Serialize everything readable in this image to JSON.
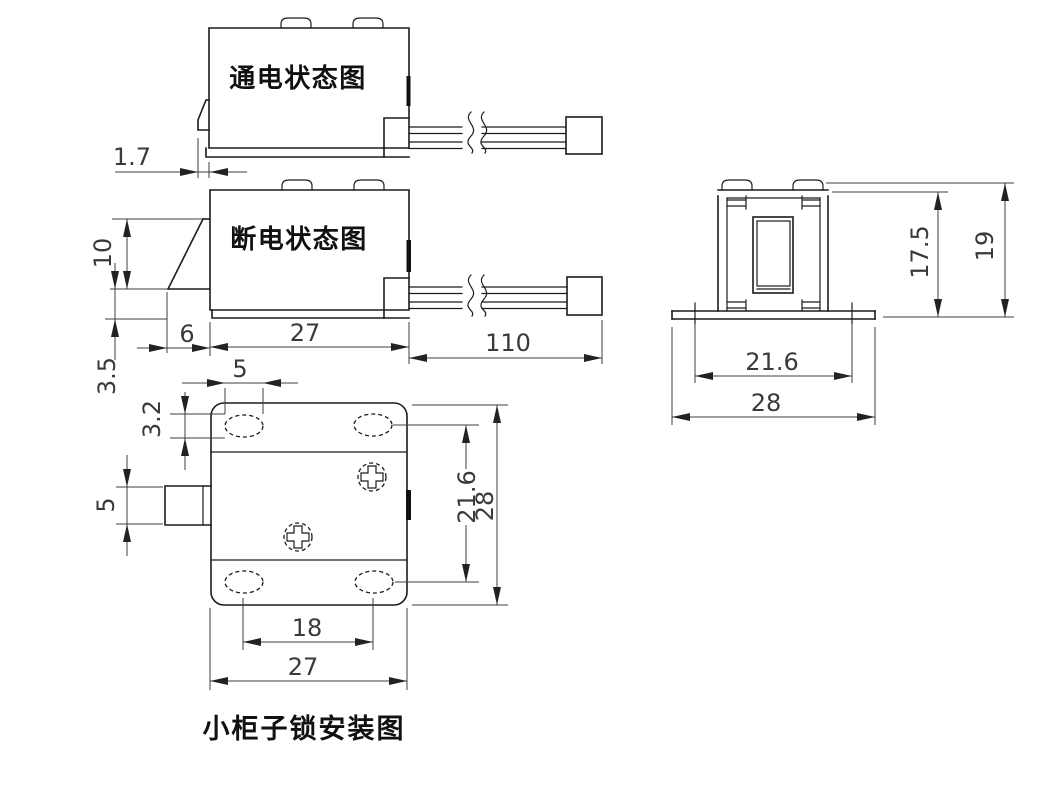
{
  "page": {
    "background": "#ffffff",
    "line_color": "#1c1c1c",
    "dimension_color": "#3f3f3f"
  },
  "views": {
    "energized": {
      "label": "通电状态图",
      "dims": {
        "bolt_offset": "1.7"
      }
    },
    "deenergized": {
      "label": "断电状态图",
      "dims": {
        "bolt_height": "10",
        "bolt_clearance": "3.5",
        "bolt_protrusion": "6",
        "body_length": "27",
        "cable_length": "110"
      }
    },
    "front": {
      "dims": {
        "slot_length": "5",
        "slot_width": "3.2",
        "latch_height": "5",
        "hole_span_vertical": "21.6",
        "height": "28",
        "hole_span_horizontal": "18",
        "width": "27"
      }
    },
    "side": {
      "dims": {
        "inner_height": "17.5",
        "height": "19",
        "hole_span": "21.6",
        "width": "28"
      }
    }
  },
  "caption": "小柜子锁安装图"
}
